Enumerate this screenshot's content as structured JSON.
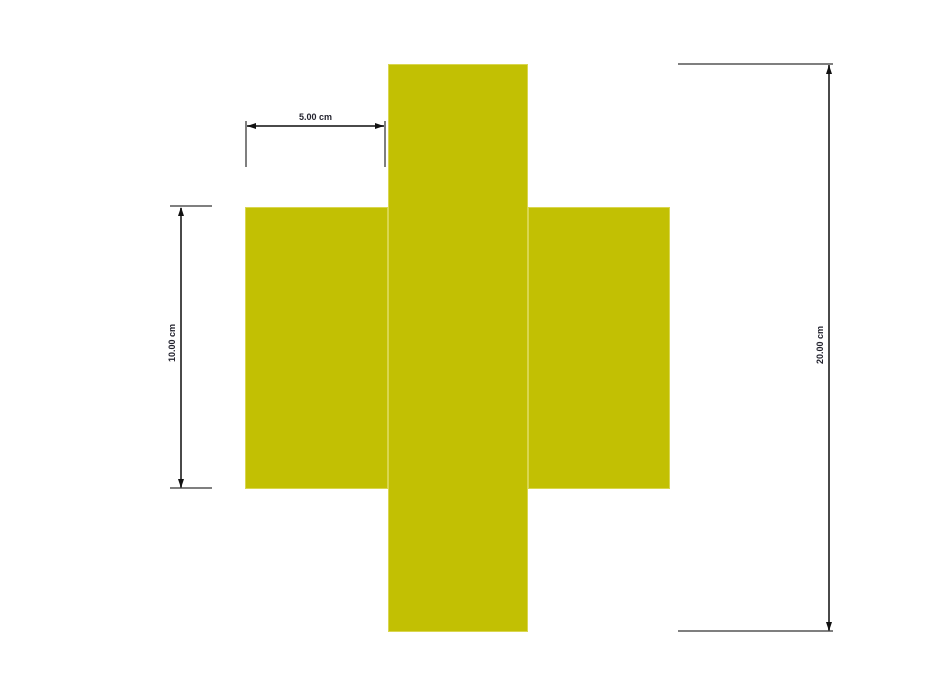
{
  "diagram": {
    "kind": "dimensioned cross-section drawing",
    "shape": "plus-cross of three rectangles",
    "colors": {
      "background": "#ffffff",
      "shape-fill": "#c2c003",
      "shape-edge": "#d9d64f",
      "dim-line": "#4a4a4a",
      "witness-line": "#7f7f7f",
      "arrow": "#111111",
      "label": "#23232e"
    },
    "dimensions": [
      {
        "label": "5.00 cm",
        "orientation": "horizontal"
      },
      {
        "label": "10.00 cm",
        "orientation": "vertical"
      },
      {
        "label": "20.00 cm",
        "orientation": "vertical"
      }
    ]
  }
}
